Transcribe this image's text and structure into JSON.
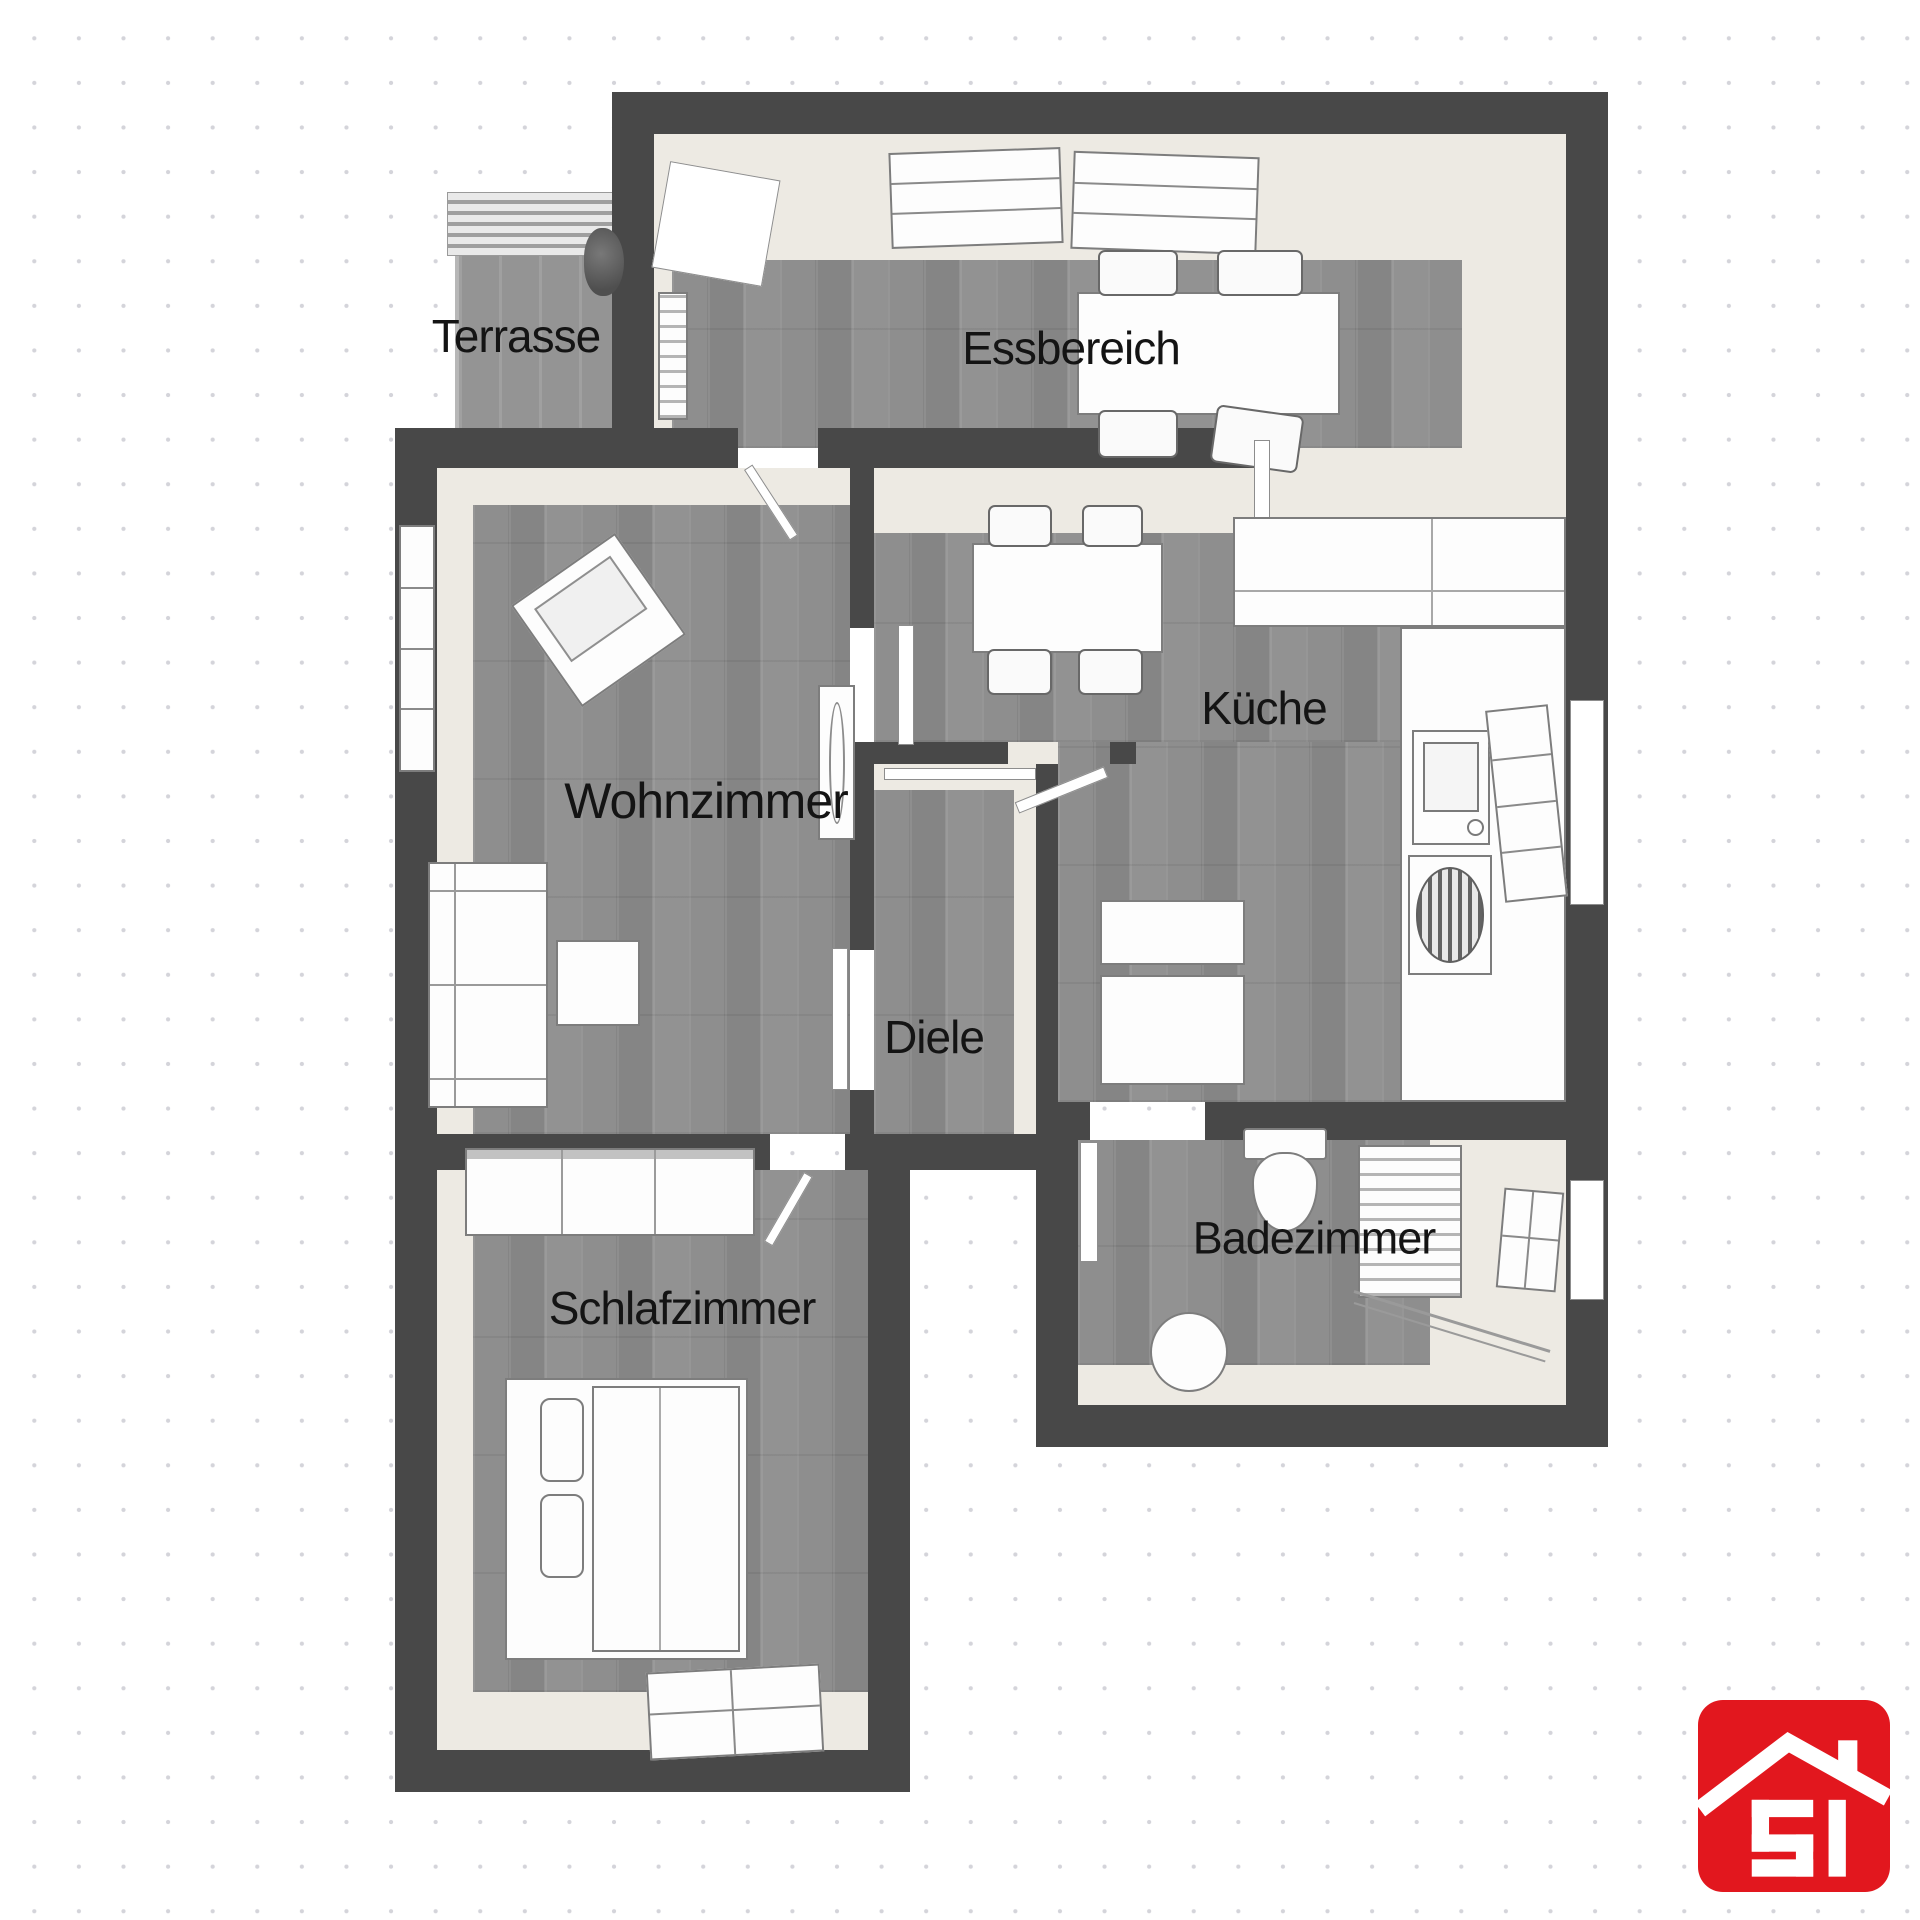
{
  "plan": {
    "type": "apartment-floor-plan",
    "style": "3d-top-down",
    "colors": {
      "background": "#ffffff",
      "dot_grid": "#d4d4da",
      "wall": "#484848",
      "wall_face_cream": "#edeae3",
      "floor_wood_gray": "#8c8c8c",
      "terrace_paving": "#9a9a9a",
      "furniture_fill": "#fdfdfd",
      "furniture_outline": "#7d7d7d",
      "label_text": "#141414"
    }
  },
  "rooms": [
    {
      "id": "terrasse",
      "label": "Terrasse",
      "features": [
        "paving",
        "pergola-slats",
        "plant"
      ]
    },
    {
      "id": "essbereich",
      "label": "Essbereich",
      "features": [
        "dining-table",
        "four-chairs",
        "two-top-windows",
        "terrace-door",
        "radiator"
      ]
    },
    {
      "id": "wohnzimmer",
      "label": "Wohnzimmer",
      "features": [
        "armchair",
        "sofa",
        "coffee-table",
        "tv-sideboard",
        "window"
      ]
    },
    {
      "id": "kueche",
      "label": "Küche",
      "features": [
        "kitchen-table",
        "four-chairs",
        "l-counter",
        "sink",
        "stove",
        "fridge-units",
        "window"
      ]
    },
    {
      "id": "diele",
      "label": "Diele",
      "features": [
        "door-to-kueche",
        "door-to-wohnzimmer"
      ]
    },
    {
      "id": "badezimmer",
      "label": "Badezimmer",
      "features": [
        "toilet",
        "washbasin",
        "radiator",
        "shower",
        "window"
      ]
    },
    {
      "id": "schlafzimmer",
      "label": "Schlafzimmer",
      "features": [
        "wardrobe",
        "double-bed",
        "two-pillows",
        "window"
      ]
    }
  ],
  "logo": {
    "text": "SI",
    "color": "#e2171e",
    "shape": "red-rounded-square-with-white-roof-and-chimney"
  }
}
